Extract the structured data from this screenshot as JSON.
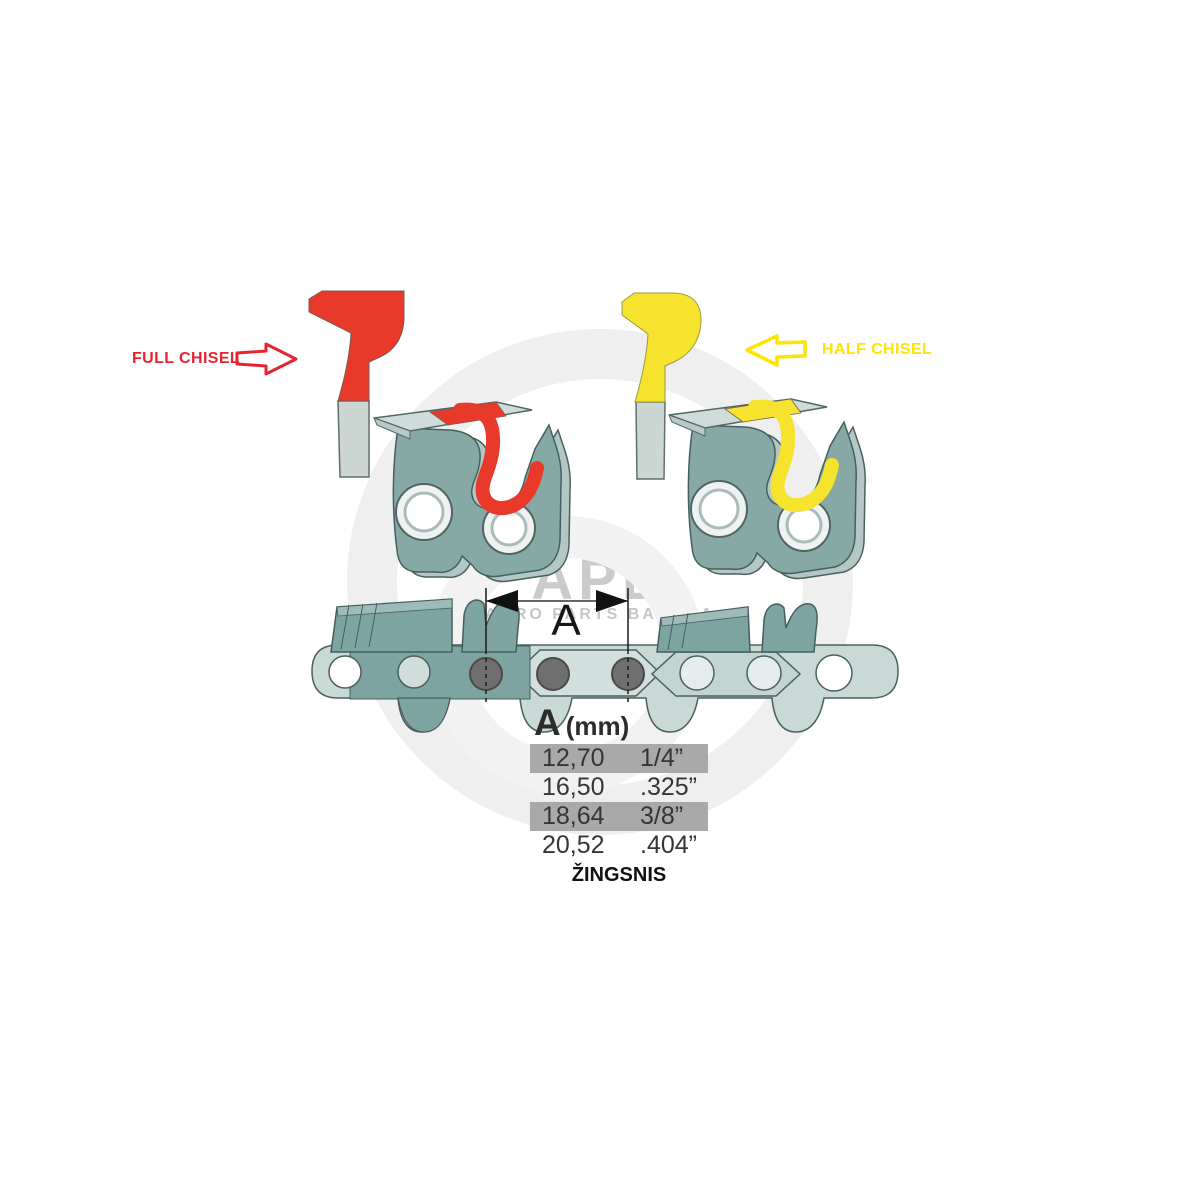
{
  "labels": {
    "full_chisel": "FULL CHISEL",
    "half_chisel": "HALF CHISEL",
    "dimension_letter": "A",
    "pitch_caption": "ŽINGSNIS"
  },
  "table": {
    "header": {
      "letter": "A",
      "unit": "(mm)"
    },
    "rows": [
      {
        "mm": "12,70",
        "inch": "1/4”",
        "highlighted": true
      },
      {
        "mm": "16,50",
        "inch": ".325”",
        "highlighted": false
      },
      {
        "mm": "18,64",
        "inch": "3/8”",
        "highlighted": true
      },
      {
        "mm": "20,52",
        "inch": ".404”",
        "highlighted": false
      }
    ]
  },
  "watermark": {
    "logo": "APB",
    "tagline": "AGRO PARTS BALTIJA"
  },
  "colors": {
    "full_chisel_red": "#e8392b",
    "half_chisel_yellow": "#f5e32d",
    "label_red": "#e52531",
    "label_yellow": "#ffe400",
    "cutter_teal": "#87a9a6",
    "cutter_dark_teal": "#7da4a1",
    "chain_light": "#c9d9d5",
    "row_highlight": "#a9a9a9",
    "rivet_gray": "#6f6f6f",
    "watermark_gray": "#efefef"
  }
}
